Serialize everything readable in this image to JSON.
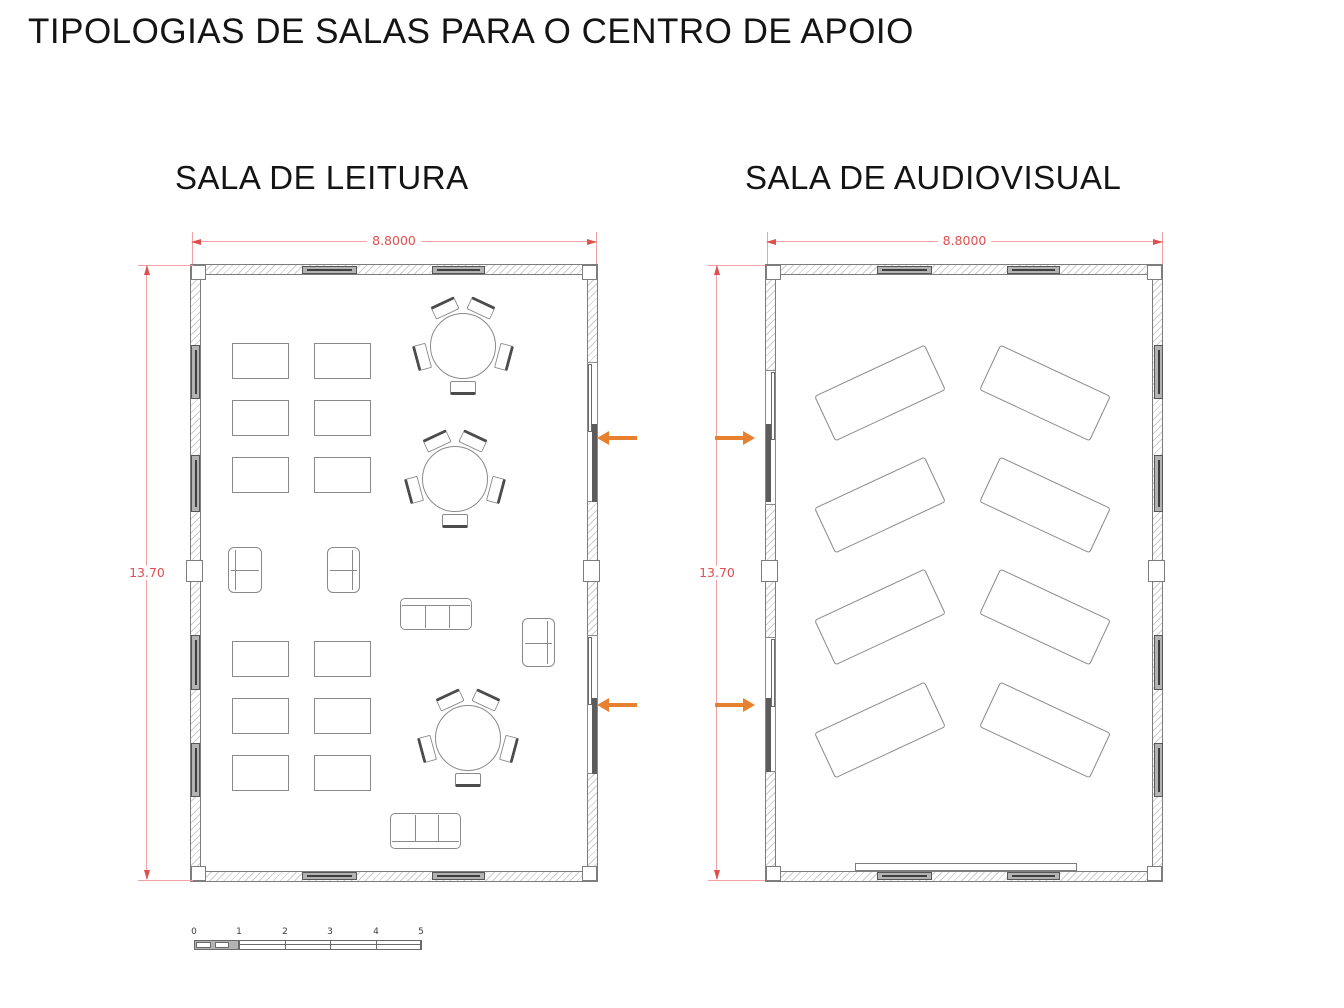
{
  "title": "TIPOLOGIAS DE SALAS PARA O CENTRO DE APOIO",
  "plans": [
    {
      "id": "leitura",
      "label": "SALA DE LEITURA",
      "width_dim": "8.8000",
      "height_dim": "13.70"
    },
    {
      "id": "audiovisual",
      "label": "SALA DE AUDIOVISUAL",
      "width_dim": "8.8000",
      "height_dim": "13.70"
    }
  ],
  "scale_bar": {
    "labels": [
      "0",
      "1",
      "2",
      "3",
      "4",
      "5"
    ]
  },
  "colors": {
    "dimension_line": "#f2a2a2",
    "dimension_text": "#e04f4f",
    "entrance_arrow": "#e8812f",
    "wall_edge": "#7d7d7d",
    "furniture_line": "#8a8a8a"
  },
  "floorplan": {
    "items": [
      [
        "wallh",
        190,
        264,
        408,
        11
      ],
      [
        "wallh",
        190,
        871,
        408,
        11
      ],
      [
        "wallv",
        190,
        264,
        11,
        618
      ],
      [
        "wallv",
        587,
        264,
        11,
        618
      ],
      [
        "col",
        191,
        265,
        15,
        15
      ],
      [
        "col",
        582,
        265,
        15,
        15
      ],
      [
        "col",
        191,
        866,
        15,
        15
      ],
      [
        "col",
        582,
        866,
        15,
        15
      ],
      [
        "col",
        186,
        560,
        17,
        22
      ],
      [
        "col",
        583,
        560,
        17,
        22
      ],
      [
        "winh",
        302,
        266,
        55,
        8
      ],
      [
        "winh",
        432,
        266,
        53,
        8
      ],
      [
        "winh",
        302,
        872,
        55,
        8
      ],
      [
        "winh",
        432,
        872,
        53,
        8
      ],
      [
        "winv",
        191,
        345,
        9,
        54
      ],
      [
        "winv",
        191,
        455,
        9,
        57
      ],
      [
        "winv",
        191,
        635,
        9,
        55
      ],
      [
        "winv",
        191,
        743,
        9,
        54
      ],
      [
        "recessv",
        587,
        362,
        11,
        140
      ],
      [
        "sashl",
        588,
        364,
        4,
        68
      ],
      [
        "sashd",
        592,
        424,
        5,
        78
      ],
      [
        "recessv",
        587,
        635,
        11,
        139
      ],
      [
        "sashl",
        588,
        637,
        4,
        68
      ],
      [
        "sashd",
        592,
        698,
        5,
        76
      ],
      [
        "wallh",
        765,
        264,
        398,
        11
      ],
      [
        "wallh",
        765,
        871,
        398,
        11
      ],
      [
        "wallv",
        765,
        264,
        11,
        618
      ],
      [
        "wallv",
        1152,
        264,
        11,
        618
      ],
      [
        "col",
        766,
        265,
        15,
        15
      ],
      [
        "col",
        1147,
        265,
        15,
        15
      ],
      [
        "col",
        766,
        866,
        15,
        15
      ],
      [
        "col",
        1147,
        866,
        15,
        15
      ],
      [
        "col",
        761,
        560,
        17,
        22
      ],
      [
        "col",
        1148,
        560,
        17,
        22
      ],
      [
        "winh",
        877,
        266,
        55,
        8
      ],
      [
        "winh",
        1007,
        266,
        53,
        8
      ],
      [
        "winh",
        877,
        872,
        55,
        8
      ],
      [
        "winh",
        1007,
        872,
        53,
        8
      ],
      [
        "winv",
        1154,
        345,
        9,
        54
      ],
      [
        "winv",
        1154,
        455,
        9,
        57
      ],
      [
        "winv",
        1154,
        635,
        9,
        55
      ],
      [
        "winv",
        1154,
        743,
        9,
        54
      ],
      [
        "recessv",
        765,
        370,
        11,
        135
      ],
      [
        "sashl",
        771,
        372,
        4,
        68
      ],
      [
        "sashd",
        766,
        424,
        5,
        78
      ],
      [
        "recessv",
        765,
        637,
        11,
        135
      ],
      [
        "sashl",
        771,
        639,
        4,
        68
      ],
      [
        "sashd",
        766,
        698,
        5,
        74
      ],
      [
        "table",
        232,
        343,
        57,
        36
      ],
      [
        "table",
        314,
        343,
        57,
        36
      ],
      [
        "table",
        232,
        400,
        57,
        36
      ],
      [
        "table",
        314,
        400,
        57,
        36
      ],
      [
        "table",
        232,
        457,
        57,
        36
      ],
      [
        "table",
        314,
        457,
        57,
        36
      ],
      [
        "table",
        232,
        641,
        57,
        36
      ],
      [
        "table",
        314,
        641,
        57,
        36
      ],
      [
        "table",
        232,
        698,
        57,
        36
      ],
      [
        "table",
        314,
        698,
        57,
        36
      ],
      [
        "table",
        232,
        755,
        57,
        36
      ],
      [
        "table",
        314,
        755,
        57,
        36
      ],
      [
        "rtable",
        463,
        346,
        33
      ],
      [
        "rtable",
        455,
        479,
        33
      ],
      [
        "rtable",
        468,
        738,
        33
      ],
      [
        "arm",
        228,
        547,
        34,
        46,
        "l"
      ],
      [
        "arm",
        327,
        547,
        33,
        46,
        "r"
      ],
      [
        "arm",
        522,
        618,
        33,
        49,
        "r"
      ],
      [
        "sofa",
        400,
        598,
        72,
        32,
        "t"
      ],
      [
        "sofa",
        390,
        813,
        71,
        36,
        "b"
      ],
      [
        "desk",
        880,
        393,
        122,
        50,
        -25
      ],
      [
        "desk",
        880,
        505,
        122,
        50,
        -25
      ],
      [
        "desk",
        880,
        617,
        122,
        50,
        -25
      ],
      [
        "desk",
        880,
        730,
        122,
        50,
        -25
      ],
      [
        "desk",
        1045,
        393,
        122,
        50,
        25
      ],
      [
        "desk",
        1045,
        505,
        122,
        50,
        25
      ],
      [
        "desk",
        1045,
        617,
        122,
        50,
        25
      ],
      [
        "desk",
        1045,
        730,
        122,
        50,
        25
      ],
      [
        "screen",
        855,
        863,
        222,
        8
      ]
    ]
  }
}
